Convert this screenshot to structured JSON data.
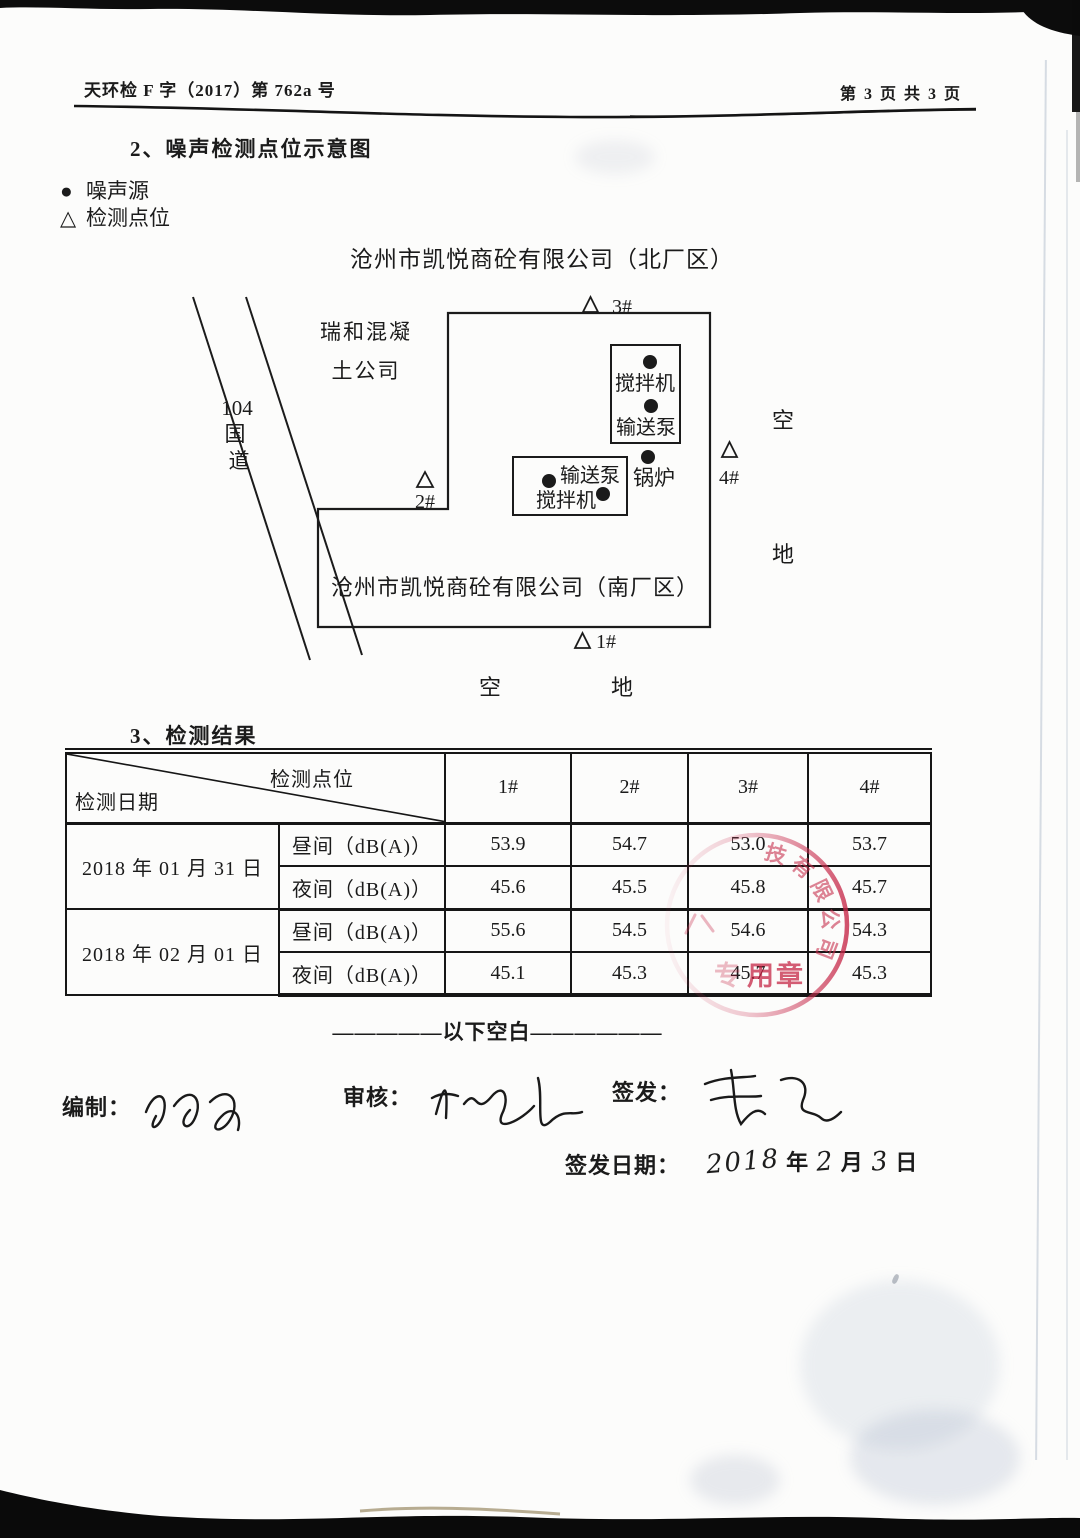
{
  "header": {
    "doc_number": "天环检 F 字（2017）第 762a 号",
    "page_info": "第 3 页 共 3 页"
  },
  "section2": {
    "title": "2、噪声检测点位示意图"
  },
  "legend": {
    "noise_source_symbol": "●",
    "noise_source_label": "噪声源",
    "detection_point_symbol": "△",
    "detection_point_label": "检测点位"
  },
  "diagram": {
    "north_factory_title": "沧州市凯悦商砼有限公司（北厂区）",
    "south_factory_label": "沧州市凯悦商砼有限公司（南厂区）",
    "neighbor_company_line1": "瑞和混凝",
    "neighbor_company_line2": "土公司",
    "road_number": "104",
    "road_char1": "国",
    "road_char2": "道",
    "point1_label": "1#",
    "point2_label": "2#",
    "point3_label": "3#",
    "point4_label": "4#",
    "mixer_north_label": "搅拌机",
    "pump_north_label": "输送泵",
    "boiler_label": "锅炉",
    "pump_south_label": "输送泵",
    "mixer_south_label": "搅拌机",
    "open_right_top": "空",
    "open_right_bottom": "地",
    "open_bottom_left": "空",
    "open_bottom_right": "地"
  },
  "section3": {
    "title": "3、检测结果"
  },
  "table": {
    "corner_top": "检测点位",
    "corner_bottom": "检测日期",
    "point_headers": [
      "1#",
      "2#",
      "3#",
      "4#"
    ],
    "rows": [
      {
        "date": "2018 年 01 月 31 日",
        "period": "昼间（dB(A)）",
        "values": [
          "53.9",
          "54.7",
          "53.0",
          "53.7"
        ]
      },
      {
        "date": "",
        "period": "夜间（dB(A)）",
        "values": [
          "45.6",
          "45.5",
          "45.8",
          "45.7"
        ]
      },
      {
        "date": "2018 年 02 月 01 日",
        "period": "昼间（dB(A)）",
        "values": [
          "55.6",
          "54.5",
          "54.6",
          "54.3"
        ]
      },
      {
        "date": "",
        "period": "夜间（dB(A)）",
        "values": [
          "45.1",
          "45.3",
          "45.7",
          "45.3"
        ]
      }
    ]
  },
  "blank_note": {
    "text": "—————以下空白——————"
  },
  "signatures": {
    "prepared_label": "编制：",
    "reviewed_label": "审核：",
    "issued_label": "签发：",
    "issue_date_label": "签发日期：",
    "year_value": "2018",
    "year_char": "年",
    "month_value": "2",
    "month_char": "月",
    "day_value": "3",
    "day_char": "日"
  },
  "stamp": {
    "arc_text": "技有限公司",
    "bottom_text": "用章",
    "color": "#c23a5a"
  },
  "colors": {
    "paper": "#fcfcfb",
    "ink": "#1b1b1b",
    "stamp_red": "#c23a5a",
    "scan_edge": "#0c0c0c"
  }
}
